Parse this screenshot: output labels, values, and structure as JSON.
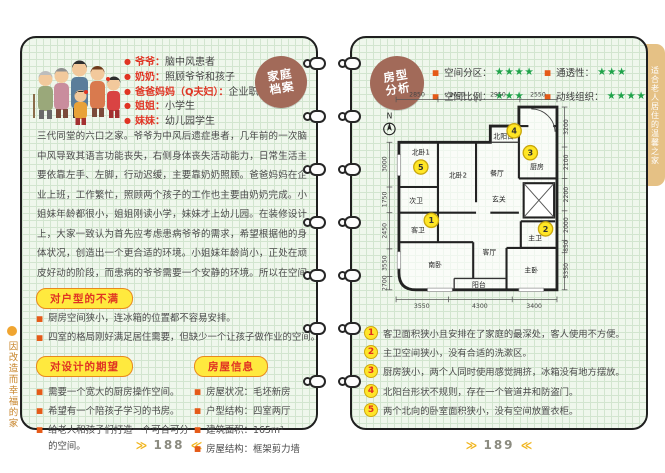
{
  "page_left": {
    "margin_note": "因改造而幸福的家",
    "badge": "家庭档案",
    "family": [
      {
        "label": "爷爷：",
        "value": "脑中风患者"
      },
      {
        "label": "奶奶：",
        "value": "照顾爷爷和孩子"
      },
      {
        "label": "爸爸妈妈（Q夫妇）：",
        "value": "企业职员"
      },
      {
        "label": "姐姐：",
        "value": "小学生"
      },
      {
        "label": "妹妹：",
        "value": "幼儿园学生"
      }
    ],
    "intro": "三代同堂的六口之家。爷爷为中风后遗症患者，几年前的一次脑中风导致其语言功能丧失，右侧身体丧失活动能力，日常生活主要依靠左手、左脚，行动迟缓，主要靠奶奶照顾。爸爸妈妈在企业上班，工作繁忙，照顾两个孩子的工作也主要由奶奶完成。小姐妹年龄都很小，姐姐刚读小学，妹妹才上幼儿园。在装修设计上，大家一致认为首先应考虑患病爷爷的需求，希望根据他的身体状况，创造出一个更合适的环境。小姐妹年龄尚小，正处在顽皮好动的阶段，而患病的爷爷需要一个安静的环境。所以在空间划分上希望能给老人和孩子打造一个可合可分的空间。",
    "complaints": {
      "title": "对户型的不满",
      "items": [
        "厨房空间狭小，连冰箱的位置都不容易安排。",
        "四室的格局刚好满足居住需要，但缺少一个让孩子做作业的空间。"
      ]
    },
    "wishes": {
      "title": "对设计的期望",
      "items": [
        "需要一个宽大的厨房操作空间。",
        "希望有一个陪孩子学习的书房。",
        "给老人和孩子们打造一个可合可分的空间。"
      ]
    },
    "house_info": {
      "title": "房屋信息",
      "items": [
        {
          "label": "房屋状况：",
          "value": "毛坯新房"
        },
        {
          "label": "户型结构：",
          "value": "四室两厅"
        },
        {
          "label": "建筑面积：",
          "value": "165m²"
        },
        {
          "label": "房屋结构：",
          "value": "框架剪力墙"
        }
      ]
    },
    "page_number": "188"
  },
  "page_right": {
    "badge": "房型分析",
    "side_tab": "适合老人居住的温馨之家",
    "ratings": [
      {
        "label": "空间分区：",
        "stars": "★★★★"
      },
      {
        "label": "空间比例：",
        "stars": "★★★"
      },
      {
        "label": "通透性：",
        "stars": "★★★"
      },
      {
        "label": "动线组织：",
        "stars": "★★★★"
      }
    ],
    "floor_plan": {
      "north_label": "N",
      "dims_top": [
        "2850",
        "2600",
        "2950",
        "2550"
      ],
      "dims_left": [
        "3000",
        "1750",
        "2450",
        "3550",
        "2700"
      ],
      "dims_right": [
        "3200",
        "2100",
        "2200",
        "2000",
        "850",
        "5350"
      ],
      "dims_bottom": [
        "3550",
        "4300",
        "3400"
      ],
      "rooms": {
        "north_bed1": "北卧1",
        "north_bed2": "北卧2",
        "dining": "餐厅",
        "north_balcony": "北阳台",
        "kitchen": "厨房",
        "second_bath": "次卫",
        "guest_bath": "客卫",
        "south_bed": "南卧",
        "living": "客厅",
        "entry": "玄关",
        "master_bath": "主卫",
        "master_bed": "主卧",
        "balcony": "阳台"
      },
      "markers": [
        "1",
        "2",
        "3",
        "4",
        "5"
      ]
    },
    "notes": [
      {
        "num": "1",
        "text": "客卫面积狭小且安排在了家庭的最深处，客人使用不方便。"
      },
      {
        "num": "2",
        "text": "主卫空间狭小，没有合适的洗漱区。"
      },
      {
        "num": "3",
        "text": "厨房狭小，两个人同时使用感觉拥挤，冰箱没有地方摆放。"
      },
      {
        "num": "4",
        "text": "北阳台形状不规则，存在一个管道井和防盗门。"
      },
      {
        "num": "5",
        "text": "两个北向的卧室面积狭小，没有空间放置衣柜。"
      }
    ],
    "page_number": "189"
  },
  "icons": {
    "round_bullet": "●",
    "square_bullet": "■",
    "footer_arrow_right": "≫",
    "footer_arrow_left": "≪"
  },
  "colors": {
    "accent_red": "#e03423",
    "pill_yellow": "#ffe93e",
    "pill_border": "#e8891d",
    "star_green": "#1fa34a",
    "badge_brown": "#a26a59",
    "marker_yellow": "#ffe625",
    "tab_tan": "#e5c185",
    "margin_orange": "#c9872e"
  }
}
